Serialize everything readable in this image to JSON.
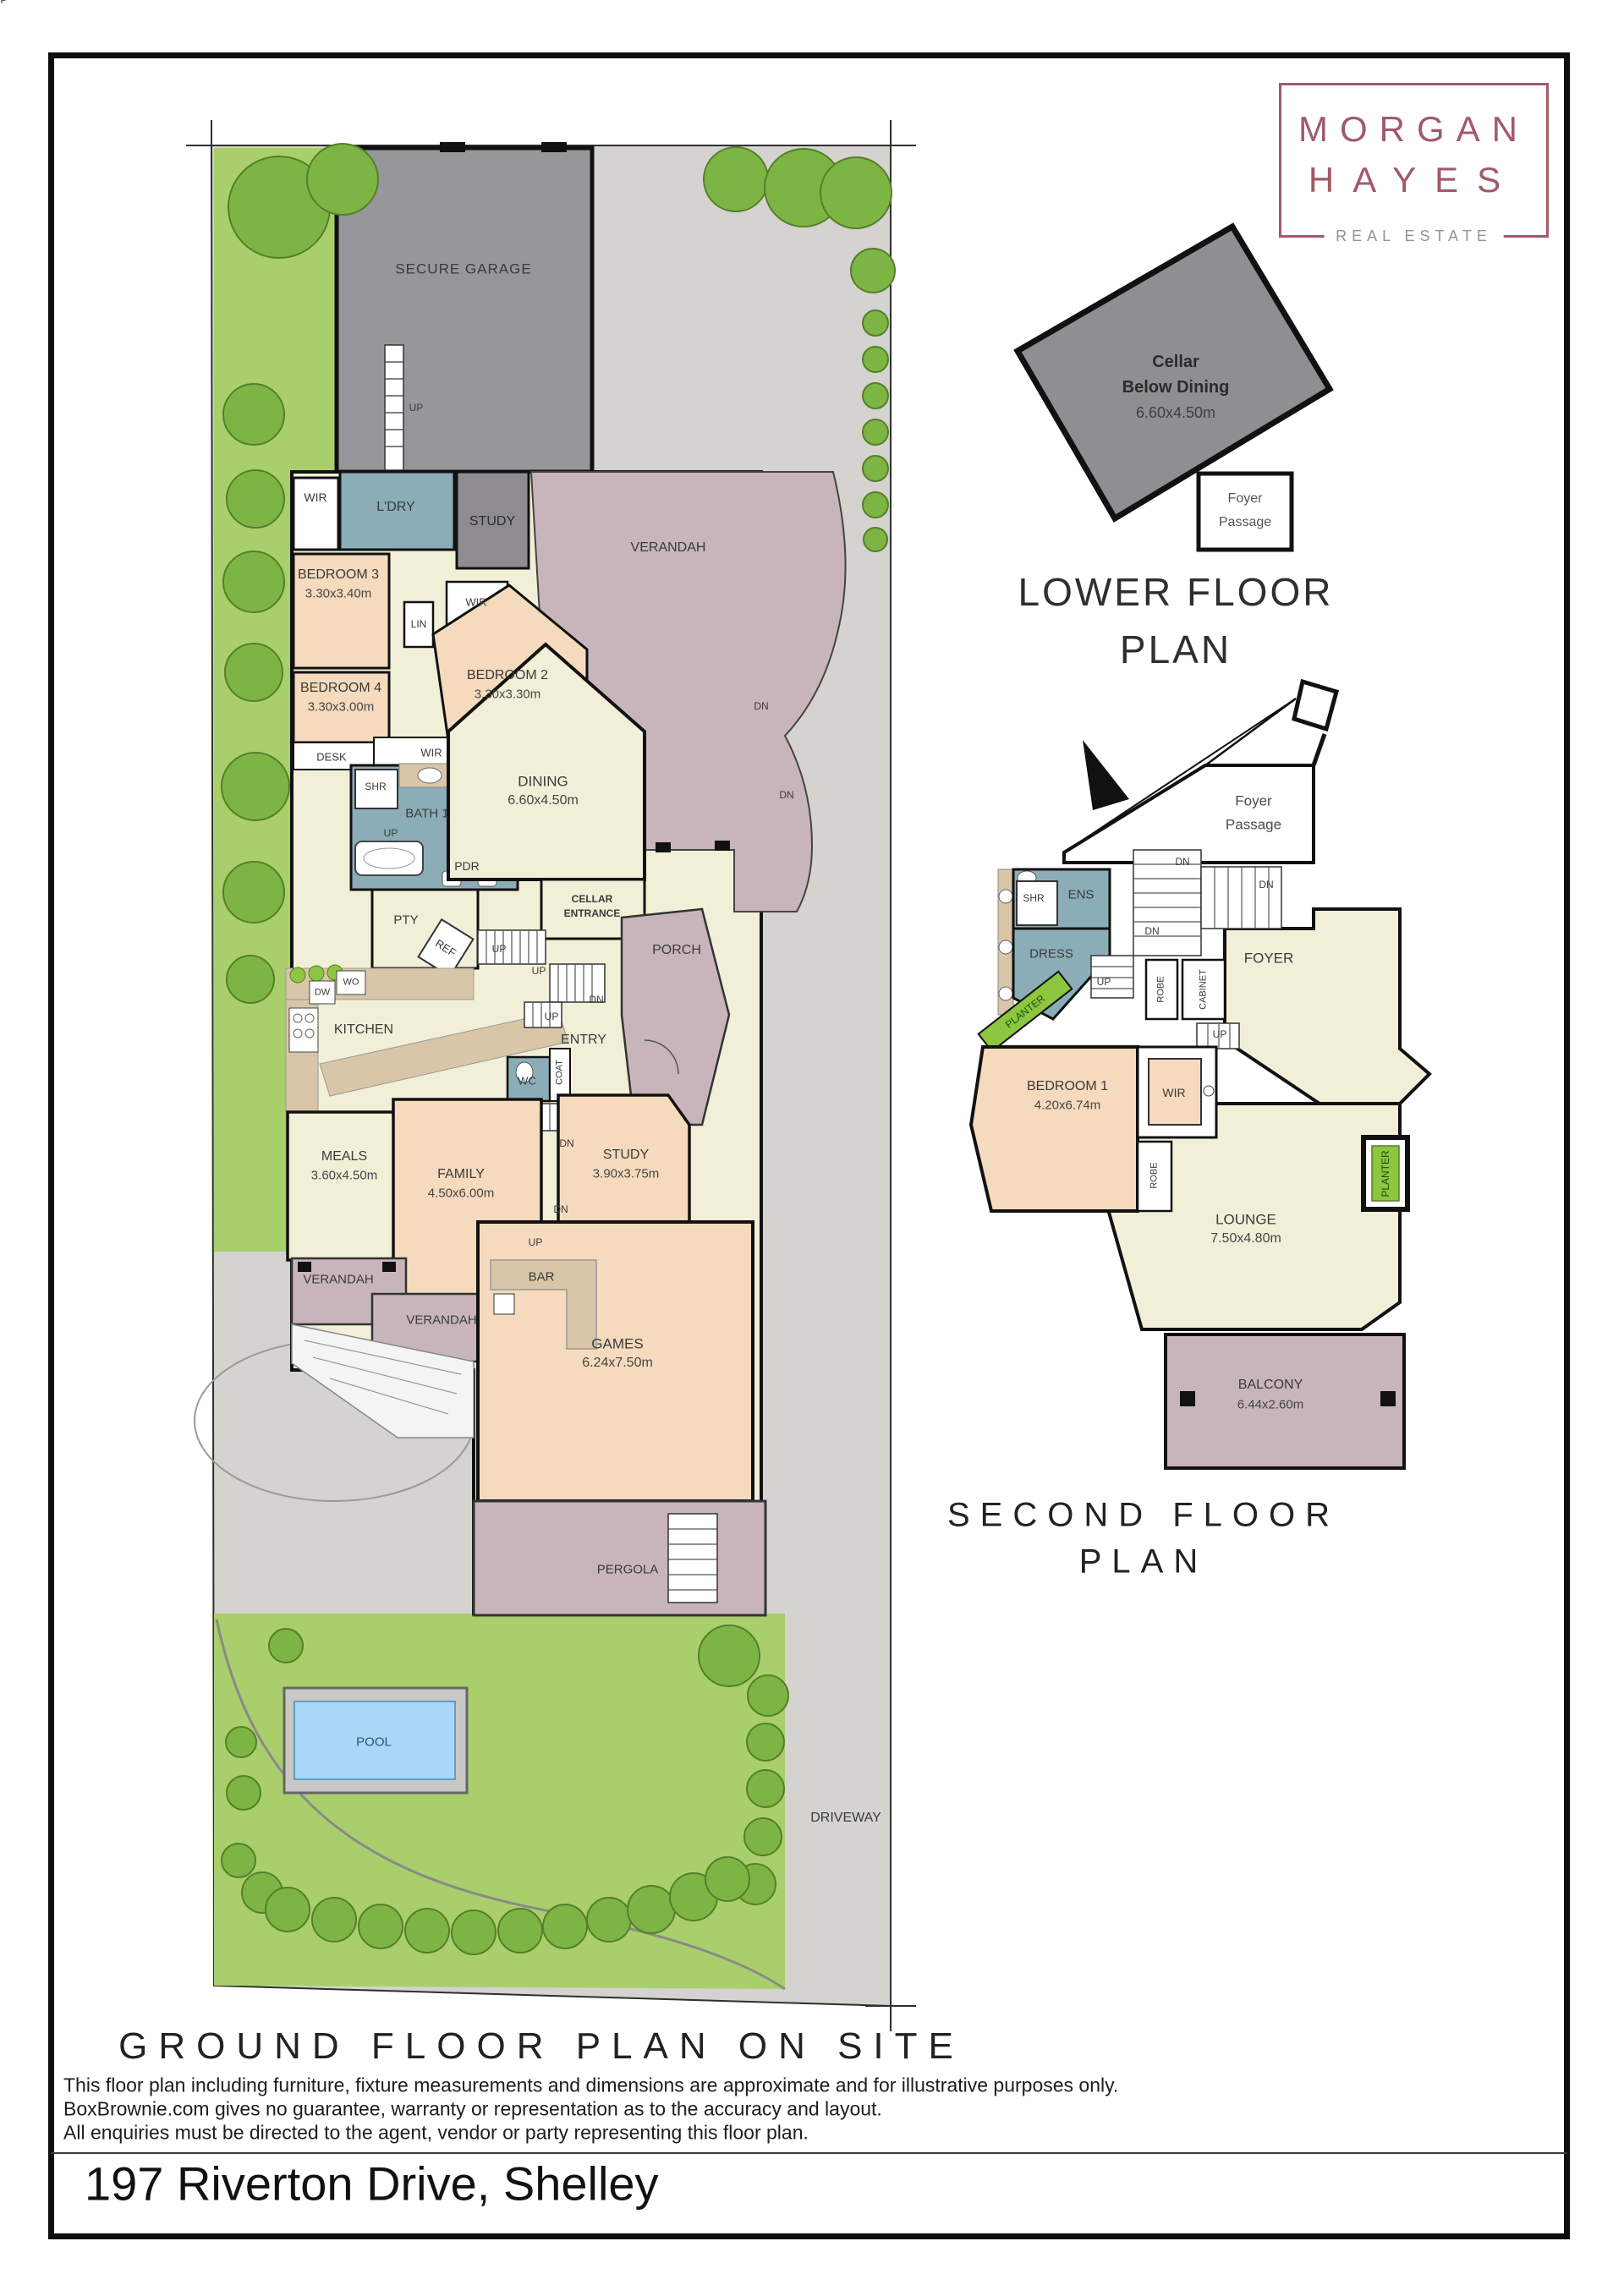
{
  "logo": {
    "line1": "MORGAN",
    "line2": "HAYES",
    "tagline": "REAL ESTATE"
  },
  "titles": {
    "lower_l1": "LOWER FLOOR",
    "lower_l2": "PLAN",
    "second_l1": "SECOND FLOOR",
    "second_l2": "PLAN",
    "ground": "GROUND FLOOR PLAN ON SITE"
  },
  "dirs": {
    "up": "UP",
    "dn": "DN"
  },
  "site": {
    "pool": "POOL",
    "driveway": "DRIVEWAY"
  },
  "lower_floor": {
    "cellar1": "Cellar",
    "cellar2": "Below Dining",
    "cellar_dims": "6.60x4.50m",
    "foyer1": "Foyer",
    "foyer2": "Passage"
  },
  "ground_floor": {
    "garage": "SECURE GARAGE",
    "wir": "WIR",
    "ldry": "L'DRY",
    "study_top": "STUDY",
    "verandah": "VERANDAH",
    "bed3": {
      "name": "BEDROOM 3",
      "dims": "3.30x3.40m"
    },
    "bed4": {
      "name": "BEDROOM 4",
      "dims": "3.30x3.00m"
    },
    "bed2": {
      "name": "BEDROOM 2",
      "dims": "3.30x3.30m"
    },
    "lin": "LIN",
    "desk": "DESK",
    "shr": "SHR",
    "bath1": "BATH 1",
    "pdr": "PDR",
    "pty": "PTY",
    "ref": "REF",
    "wo": "WO",
    "dw": "DW",
    "kitchen": "KITCHEN",
    "dining": {
      "name": "DINING",
      "dims": "6.60x4.50m"
    },
    "cellar_ent1": "CELLAR",
    "cellar_ent2": "ENTRANCE",
    "porch": "PORCH",
    "entry": "ENTRY",
    "wc": "WC",
    "coat": "COAT",
    "meals": {
      "name": "MEALS",
      "dims": "3.60x4.50m"
    },
    "family": {
      "name": "FAMILY",
      "dims": "4.50x6.00m"
    },
    "study": {
      "name": "STUDY",
      "dims": "3.90x3.75m"
    },
    "bar": "BAR",
    "games": {
      "name": "GAMES",
      "dims": "6.24x7.50m"
    },
    "pergola": "PERGOLA"
  },
  "second_floor": {
    "foyer_passage1": "Foyer",
    "foyer_passage2": "Passage",
    "ens": "ENS",
    "shr": "SHR",
    "dress": "DRESS",
    "planter": "PLANTER",
    "robe": "ROBE",
    "cabinet": "CABINET",
    "foyer": "FOYER",
    "bed1": {
      "name": "BEDROOM 1",
      "dims": "4.20x6.74m"
    },
    "wir": "WIR",
    "lounge": {
      "name": "LOUNGE",
      "dims": "7.50x4.80m"
    },
    "balcony": {
      "name": "BALCONY",
      "dims": "6.44x2.60m"
    }
  },
  "disclaimer": {
    "line1": "This floor plan including furniture, fixture measurements and dimensions are approximate and for illustrative purposes only.",
    "line2": "BoxBrownie.com gives no guarantee, warranty or representation as to the accuracy and layout.",
    "line3": "All enquiries must be directed to the agent, vendor or party representing this floor plan."
  },
  "address": "197 Riverton Drive, Shelley"
}
